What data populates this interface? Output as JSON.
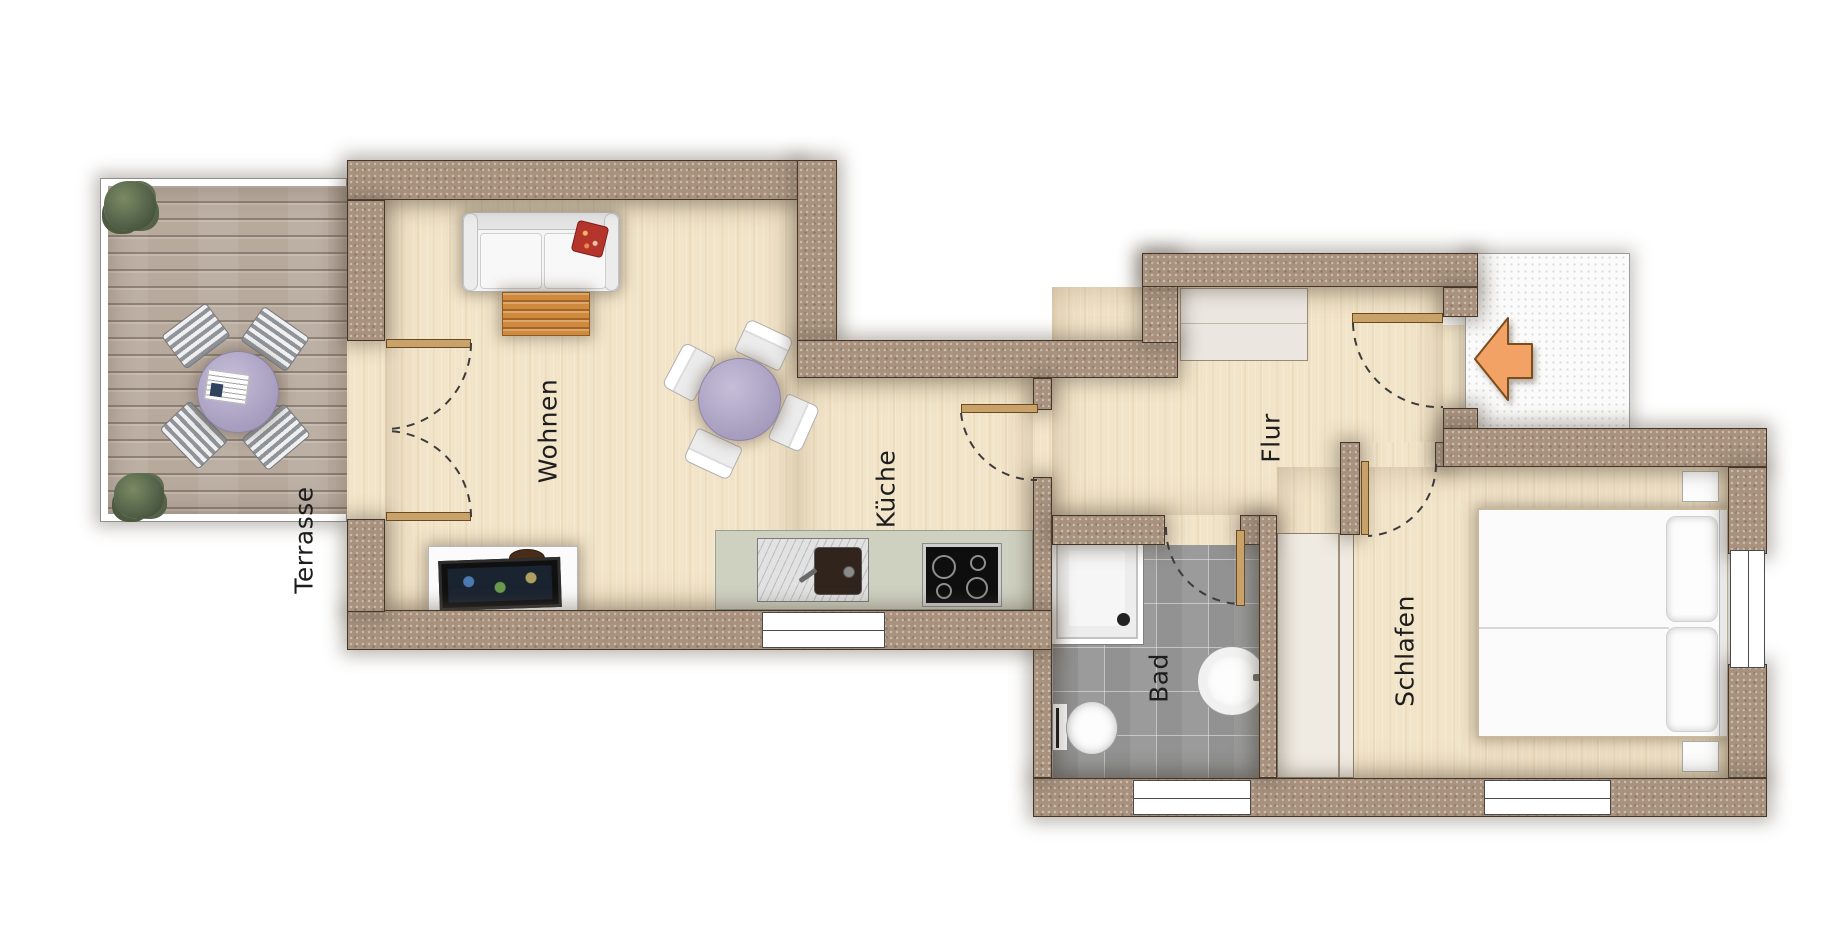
{
  "plan": {
    "type": "apartment-floor-plan",
    "rooms": [
      {
        "id": "terrasse",
        "label": "Terrasse",
        "floor": "wood-deck",
        "items": [
          "potted-plant",
          "potted-plant",
          "round-table",
          "newspaper",
          "deck-chair",
          "deck-chair",
          "deck-chair",
          "deck-chair"
        ]
      },
      {
        "id": "wohnen",
        "label": "Wohnen",
        "floor": "light-parquet",
        "items": [
          "sofa",
          "red-cushion",
          "coffee-table",
          "tv-sideboard",
          "flat-tv",
          "decor-bowl",
          "dining-table",
          "chair",
          "chair",
          "chair",
          "chair",
          "double-door-to-terrace"
        ]
      },
      {
        "id": "kueche",
        "label": "Küche",
        "floor": "light-parquet",
        "items": [
          "kitchen-counter",
          "sink",
          "cooktop",
          "window",
          "door-to-hall"
        ]
      },
      {
        "id": "flur",
        "label": "Flur",
        "floor": "light-parquet",
        "items": [
          "sideboard",
          "entrance-door",
          "entry-arrow"
        ]
      },
      {
        "id": "bad",
        "label": "Bad",
        "floor": "gray-tiles",
        "items": [
          "shower",
          "toilet",
          "washbasin",
          "window",
          "door"
        ]
      },
      {
        "id": "schlafen",
        "label": "Schlafen",
        "floor": "light-parquet",
        "items": [
          "double-bed",
          "pillow",
          "pillow",
          "nightstand",
          "nightstand",
          "wardrobe",
          "window",
          "window",
          "door"
        ]
      }
    ],
    "icons": {
      "entry_arrow": "left-arrow"
    },
    "colors": {
      "wall": "#a8927e",
      "wall_edge": "#46362a",
      "parquet": "#f2e4c8",
      "deck": "#b7a99c",
      "tiles": "#9b9b9b",
      "counter": "#ced0c0",
      "table_top": "#b4abc9",
      "coffee_table": "#d08a3e",
      "entry_arrow": "#f3a266",
      "red_cushion": "#b5342c",
      "door_leaf": "#c9a26a"
    }
  }
}
